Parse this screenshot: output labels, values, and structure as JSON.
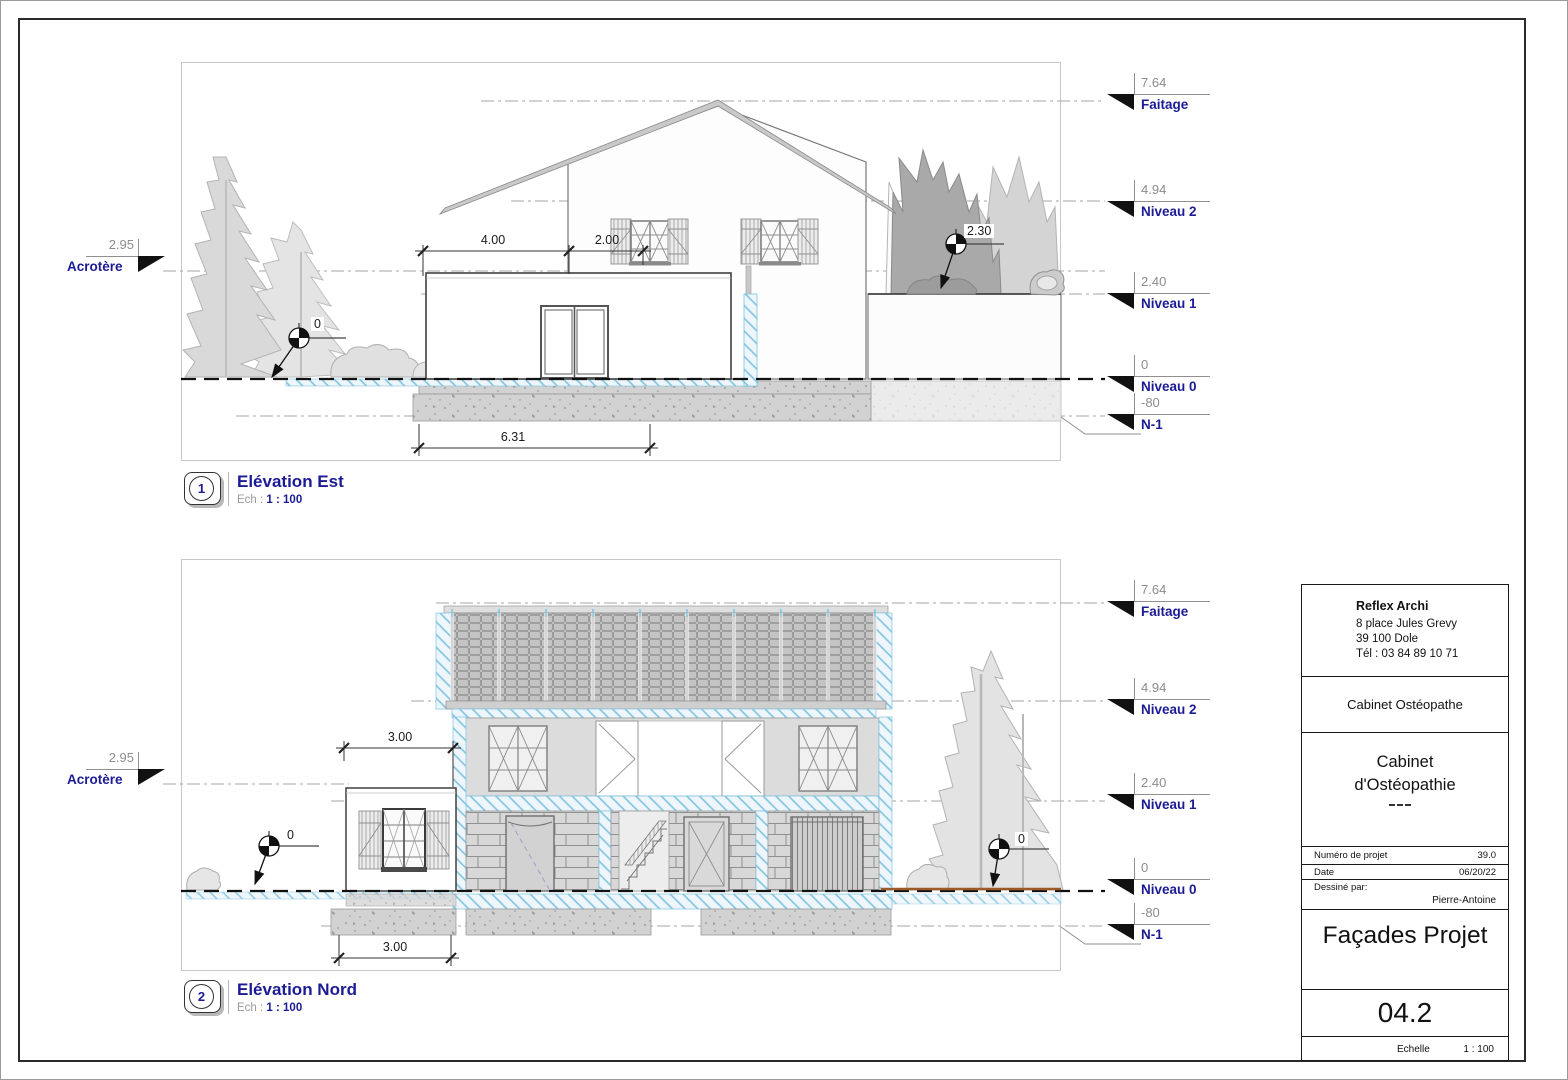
{
  "title_block": {
    "firm_name": "Reflex Archi",
    "address_line1": "8 place Jules Grevy",
    "address_line2": "39 100 Dole",
    "phone": "Tél : 03 84 89 10 71",
    "client": "Cabinet Ostéopathe",
    "project_line1": "Cabinet",
    "project_line2": "d'Ostéopathie",
    "project_number_label": "Numéro de projet",
    "project_number": "39.0",
    "date_label": "Date",
    "date": "06/20/22",
    "drawn_by_label": "Dessiné par:",
    "drawn_by": "Pierre-Antoine",
    "sheet_title": "Façades Projet",
    "sheet_number": "04.2",
    "scale_label": "Echelle",
    "scale": "1 : 100"
  },
  "views": [
    {
      "number": "1",
      "title": "Elévation Est",
      "scale_label": "Ech :",
      "scale": "1 : 100",
      "acrotere": {
        "value": "2.95",
        "label": "Acrotère"
      },
      "levels": [
        {
          "value": "7.64",
          "label": "Faitage"
        },
        {
          "value": "4.94",
          "label": "Niveau 2"
        },
        {
          "value": "2.40",
          "label": "Niveau 1"
        },
        {
          "value": "0",
          "label": "Niveau 0"
        },
        {
          "value": "-80",
          "label": "N-1"
        }
      ],
      "dimensions": {
        "upper_left": "4.00",
        "upper_right": "2.00",
        "bottom": "6.31"
      },
      "spot_elevations": {
        "ground": "0",
        "wall": "2.30"
      }
    },
    {
      "number": "2",
      "title": "Elévation Nord",
      "scale_label": "Ech :",
      "scale": "1 : 100",
      "acrotere": {
        "value": "2.95",
        "label": "Acrotère"
      },
      "levels": [
        {
          "value": "7.64",
          "label": "Faitage"
        },
        {
          "value": "4.94",
          "label": "Niveau 2"
        },
        {
          "value": "2.40",
          "label": "Niveau 1"
        },
        {
          "value": "0",
          "label": "Niveau 0"
        },
        {
          "value": "-80",
          "label": "N-1"
        }
      ],
      "dimensions": {
        "upper": "3.00",
        "bottom": "3.00"
      },
      "spot_elevations": {
        "left": "0",
        "right": "0"
      }
    }
  ],
  "colors": {
    "label_blue": "#1b1b96",
    "value_gray": "#8c8c8c",
    "hatch_blue": "#7fc3e0",
    "ground_brown": "#9c5a28"
  }
}
